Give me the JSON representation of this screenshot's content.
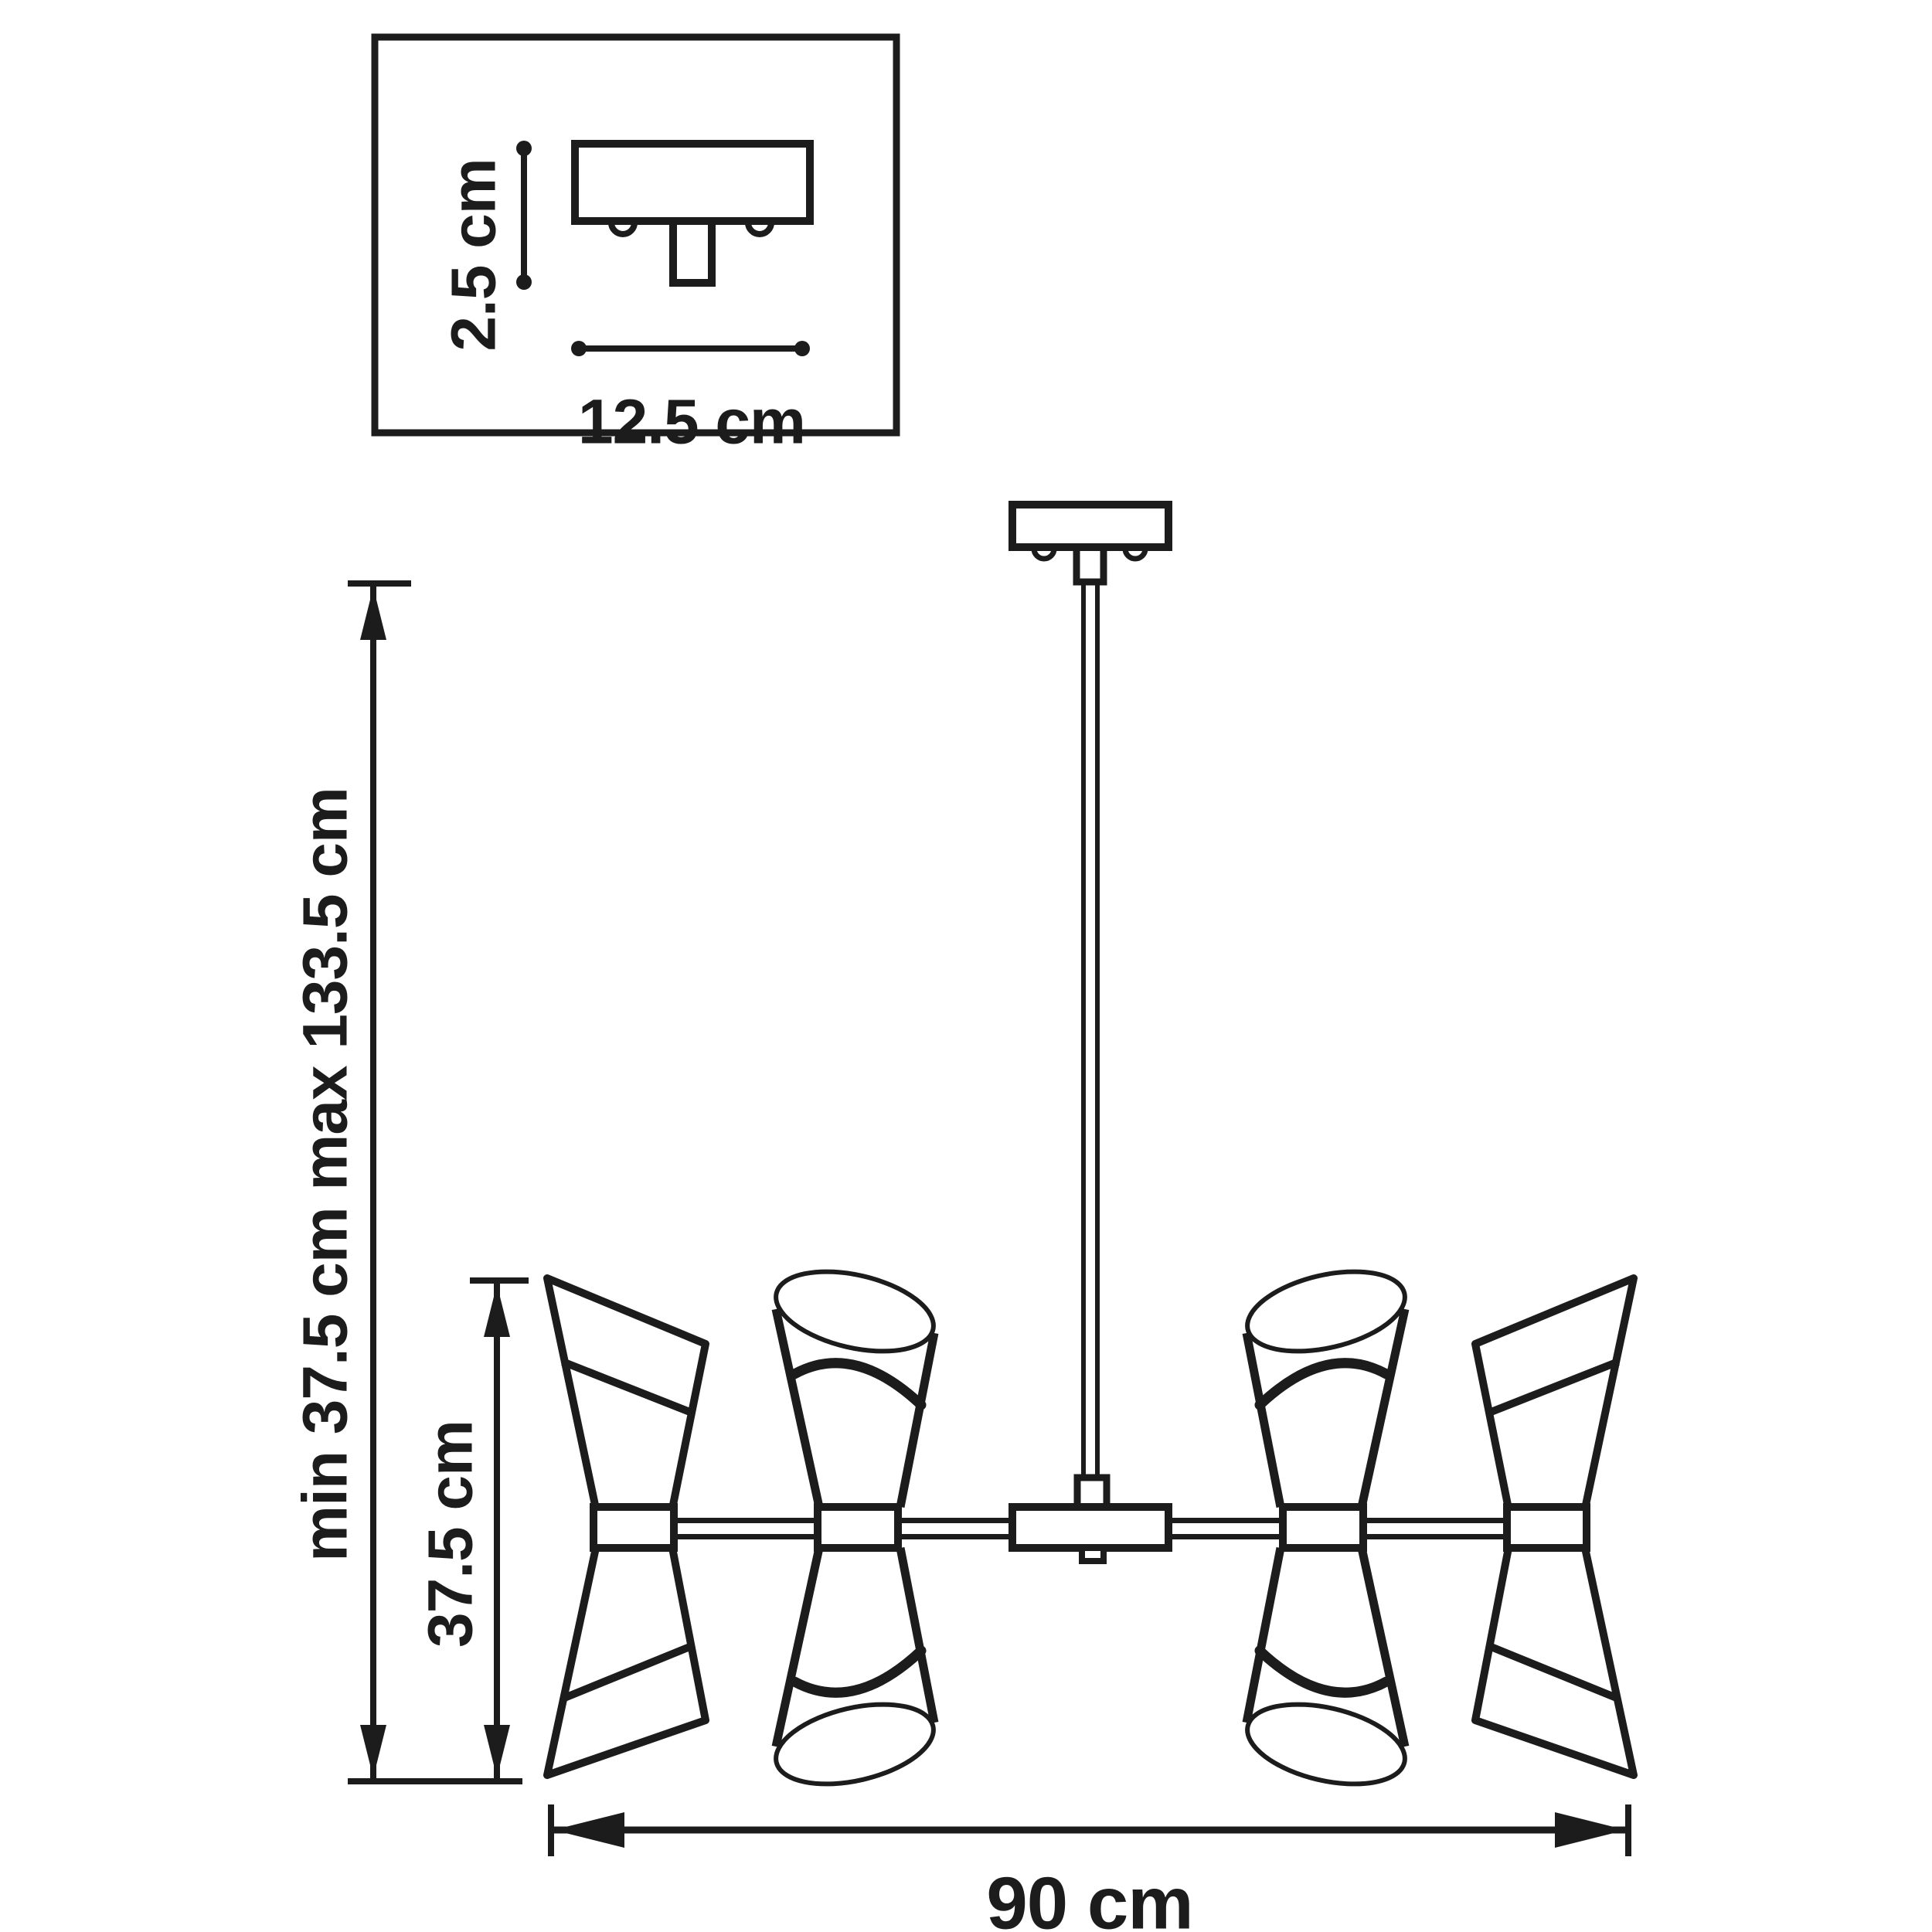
{
  "drawing": {
    "kind": "technical-dimension-drawing",
    "subject": "8-light chandelier with hourglass cone shades",
    "background_color": "#ffffff",
    "line_color": "#1c1c1c"
  },
  "inset": {
    "height_label": "2.5 cm",
    "width_label": "12.5 cm"
  },
  "dimensions": {
    "drop_height_label": "min 37.5 cm max 133.5 cm",
    "shade_height_label": "37.5 cm",
    "width_label": "90 cm"
  }
}
